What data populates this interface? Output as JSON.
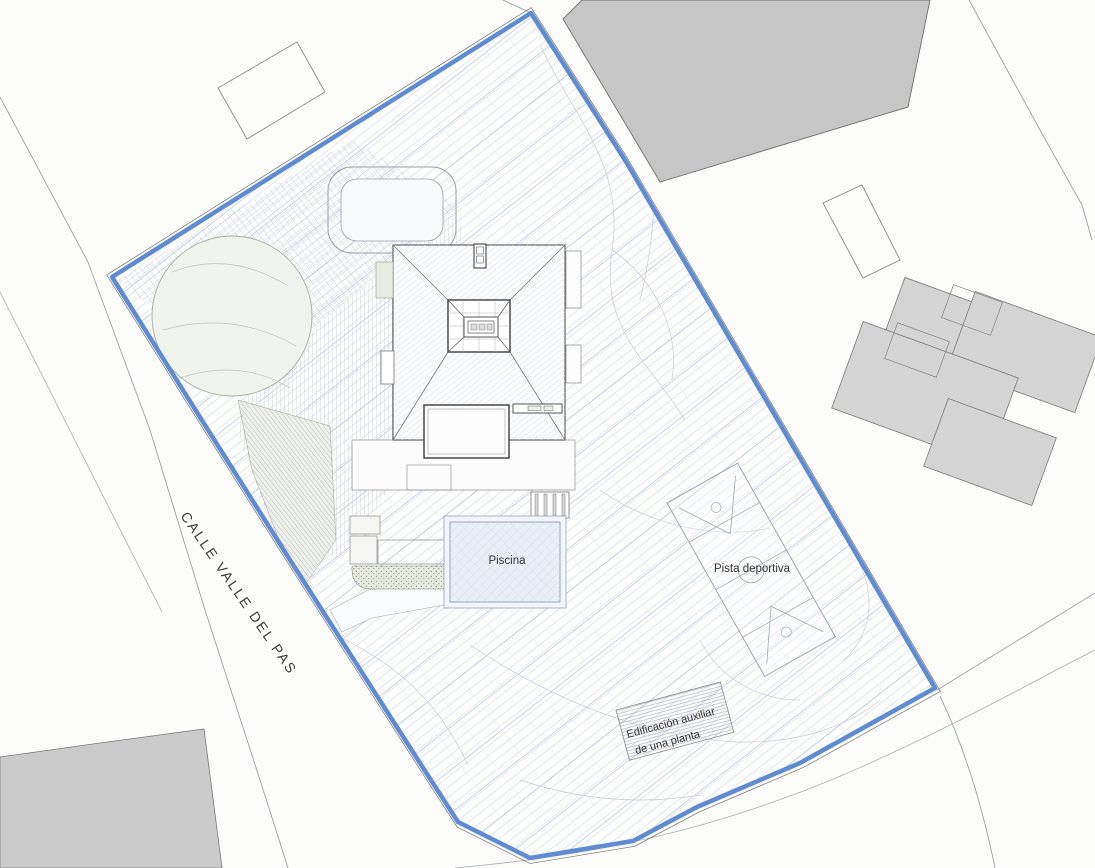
{
  "labels": {
    "street_name": "CALLE VALLE DEL PAS",
    "pool": "Piscina",
    "sports_court": "Pista deportiva",
    "aux_building_line1": "Edificación auxiliar",
    "aux_building_line2": "de una planta"
  },
  "colors": {
    "parcel_boundary": "#5e8bd2",
    "hatch_light": "#ccd5e6",
    "hatch_accent": "#aebdd8",
    "neighbor_building_fill": "#c6c6c6",
    "neighbor_house_fill": "#d4d4d4",
    "outline_gray": "#9aa0a6",
    "drawing_dark": "#4a4a4a",
    "label_text": "#333333",
    "pool_water": "#e9eff7",
    "background": "#fcfcfa"
  }
}
